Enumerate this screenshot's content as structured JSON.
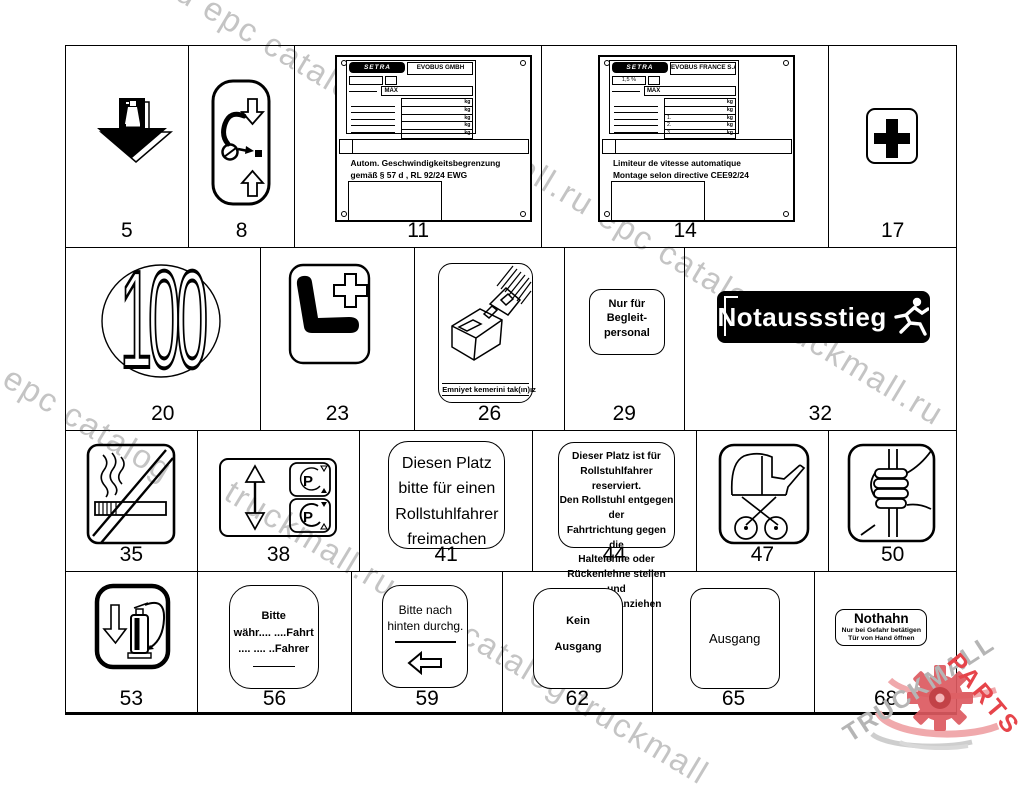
{
  "watermark": {
    "lines": [
      "truckmall.ru epc catalog",
      "truckmall.ru epc catalog truckmall.ru",
      "truckmall.ru epc catalog",
      "truckmall.ru epc catalog truckmall"
    ],
    "color": "#adadad"
  },
  "brand": {
    "gray_text": "TRUCKMALL",
    "red_text": "PARTS",
    "gray": "#b5b5b5",
    "red": "#e6444a",
    "gear_red": "#dd5a60",
    "gear_pink": "#f0a9ac",
    "swoosh_gray": "#cecece"
  },
  "items": {
    "5": {
      "number": "5"
    },
    "8": {
      "number": "8"
    },
    "11": {
      "number": "11",
      "plate": {
        "logo": "SETRA",
        "maker": "EVOBUS GMBH",
        "sub": "",
        "max": "MAX",
        "kg": "kg",
        "prefixes": [
          "",
          "",
          ""
        ],
        "caption": [
          "Autom. Geschwindigkeitsbegrenzung",
          "gemäß § 57 d , RL 92/24 EWG"
        ]
      }
    },
    "14": {
      "number": "14",
      "plate": {
        "logo": "SETRA",
        "maker": "EVOBUS FRANCE S.A.S",
        "sub": "1,5 %",
        "max": "MAX",
        "kg": "kg",
        "prefixes": [
          "1.",
          "2.",
          "3."
        ],
        "caption": [
          "Limiteur de vitesse automatique",
          "Montage selon directive CEE92/24"
        ]
      }
    },
    "17": {
      "number": "17"
    },
    "20": {
      "number": "20",
      "speed": "100"
    },
    "23": {
      "number": "23"
    },
    "26": {
      "number": "26",
      "caption": "Emniyet kemerini tak(ın)ız"
    },
    "29": {
      "number": "29",
      "lines": [
        "Nur für",
        "Begleit-",
        "personal"
      ]
    },
    "32": {
      "number": "32",
      "label": "Notaussstieg"
    },
    "35": {
      "number": "35"
    },
    "38": {
      "number": "38",
      "p": "P"
    },
    "41": {
      "number": "41",
      "lines": [
        "Diesen Platz",
        "bitte für einen",
        "Rollstuhlfahrer",
        "freimachen"
      ]
    },
    "44": {
      "number": "44",
      "lines": [
        "Dieser Platz ist für",
        "Rollstuhlfahrer reserviert.",
        "Den Rollstuhl entgegen der",
        "Fahrtrichtung gegen die",
        "Haltelehne oder",
        "Rückenlehne stellen und",
        "Bremsen anziehen"
      ]
    },
    "47": {
      "number": "47"
    },
    "50": {
      "number": "50"
    },
    "53": {
      "number": "53"
    },
    "56": {
      "number": "56",
      "lines": [
        "Bitte",
        "währ.... ....Fahrt",
        ".... .... ..Fahrer"
      ]
    },
    "59": {
      "number": "59",
      "lines": [
        "Bitte nach",
        "hinten durchg."
      ]
    },
    "62": {
      "number": "62",
      "lines": [
        "Kein",
        "Ausgang"
      ]
    },
    "65": {
      "number": "65",
      "label": "Ausgang"
    },
    "68": {
      "number": "68",
      "title": "Nothahn",
      "lines": [
        "Nur bei Gefahr betätigen",
        "Tür von Hand öffnen"
      ]
    }
  }
}
